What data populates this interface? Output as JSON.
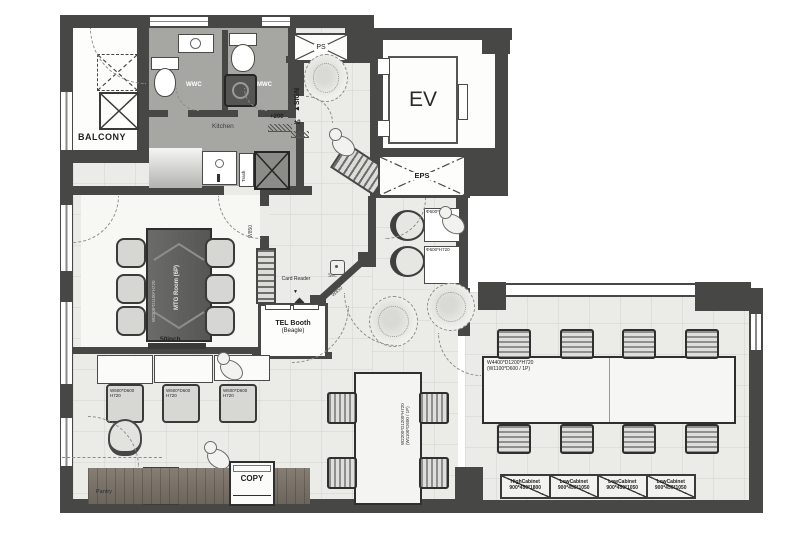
{
  "colors": {
    "wall": "#474745",
    "wet_floor": "#a6a6a3",
    "floor": "#ebebe8",
    "wood": "#7d756b",
    "accent_dark": "#3a3a38"
  },
  "rooms": {
    "balcony": {
      "label": "BALCONY"
    },
    "wwc": {
      "label": "WWC"
    },
    "mwc": {
      "label": "MWC"
    },
    "kitchen": {
      "label": "Kitchen",
      "trash": "Trash",
      "level_up": "+200",
      "level_zero": "±0"
    },
    "ps": {
      "label": "PS"
    },
    "entry": {
      "sign": "▲SIGN"
    },
    "ev": {
      "label": "EV"
    },
    "eps": {
      "label": "EPS"
    },
    "mtg": {
      "label": "MTG Room (6P)",
      "table_size": "W2200*D1100*H720",
      "monitor": "50inch",
      "door_width": "W850"
    },
    "tel": {
      "label": "TEL Booth",
      "sublabel": "(Beagle)",
      "door_width": "W850"
    },
    "pantry": {
      "label": "Pantry"
    }
  },
  "annotations": {
    "card_reader": "Card Reader",
    "security": "Sec",
    "copy": "COPY",
    "arrow_down": "▼"
  },
  "furniture": {
    "reception_desk": {
      "size": "Φ600*H720"
    },
    "work_desk": {
      "size_line1": "W600*D600",
      "size_line2": "H720"
    },
    "center_table": {
      "size_line1": "W2200*D1200*H720",
      "size_line2": "(W1100*D600 / 1P)"
    },
    "office_island": {
      "size_line1": "W4400*D1200*H720",
      "size_line2": "(W1100*D600 / 1P)"
    }
  },
  "cabinets": [
    {
      "name": "HighCabinet",
      "size": "900*450*1800"
    },
    {
      "name": "LowCabinet",
      "size": "900*450*1050"
    },
    {
      "name": "LowCabinet",
      "size": "900*450*1050"
    },
    {
      "name": "LowCabinet",
      "size": "900*450*1050"
    }
  ]
}
